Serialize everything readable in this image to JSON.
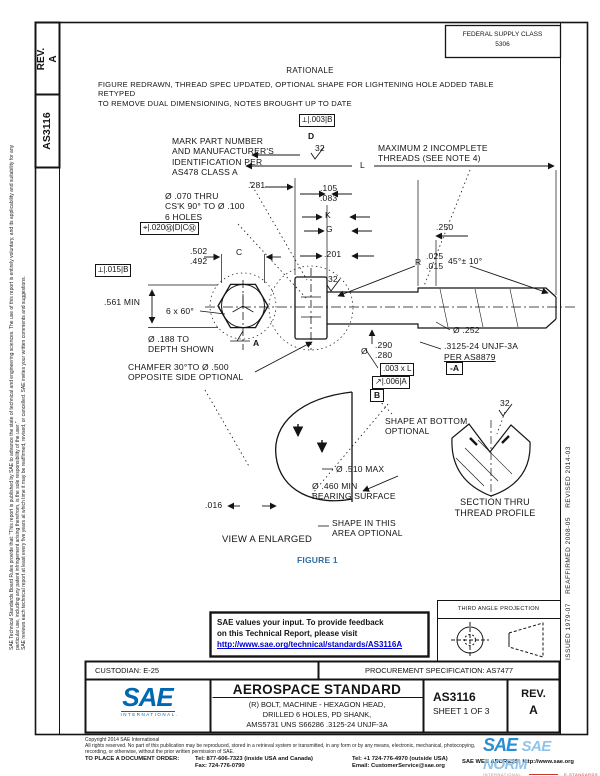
{
  "document": {
    "rev_label": "REV.",
    "rev_value": "A",
    "doc_number": "AS3116",
    "federal_supply_class": "FEDERAL SUPPLY CLASS",
    "federal_supply_value": "5306"
  },
  "rationale": {
    "title": "RATIONALE",
    "text": "FIGURE REDRAWN, THREAD SPEC UPDATED, OPTIONAL SHAPE FOR LIGHTENING HOLE ADDED TABLE RETYPED\nTO REMOVE DUAL DIMENSIONING, NOTES BROUGHT UP TO DATE"
  },
  "margins": {
    "left_legal_1": "SAE Technical Standards Board Rules provide that: \"This report is published by SAE to advance the state of technical and engineering sciences. The use of this report is entirely voluntary, and its applicability and suitability for any particular use, including any patent infringement arising therefrom, is the sole responsibility of the user.\"",
    "left_legal_2": "SAE reviews each technical report at least every five years at which time it may be reaffirmed, revised, or cancelled. SAE invites your written comments and suggestions.",
    "revision_history": "ISSUED 1979-07    REAFFIRMED 2008-05    REVISED 2014-03"
  },
  "drawing": {
    "figure_caption": "FIGURE 1",
    "callouts": {
      "fcf_top": "⟂|.003|B",
      "datum_d": "D",
      "finish_top": "32",
      "mark_part": "MARK PART NUMBER\nAND MANUFACTURER'S\nIDENTIFICATION PER\nAS478 CLASS A",
      "max_threads": "MAXIMUM 2 INCOMPLETE\nTHREADS (SEE NOTE 4)",
      "dim_l": "L",
      "dim_281": ".281",
      "dim_105_083": ".105\n.083",
      "dim_k": "K",
      "dim_g": "G",
      "hole_note": "Ø .070 THRU\nCS'K 90° TO Ø .100\n6 HOLES",
      "fcf_position": "⌖|.020Ⓜ|D|CⓂ",
      "dim_502_492": ".502\n.492",
      "dim_c": "C",
      "dim_201": ".201",
      "dim_r": "R",
      "dim_r_vals": ".025\n.015",
      "dim_250": ".250",
      "dim_45": "45°± 10°",
      "fcf_perp": "⟂|.015|B",
      "dim_561": ".561 MIN",
      "dim_6x60": "6 x 60°",
      "finish_head": "32",
      "dim_188": "Ø .188 TO\nDEPTH SHOWN",
      "view_arrow": "A",
      "chamfer_note": "CHAMFER 30°TO Ø .500\nOPPOSITE SIDE OPTIONAL",
      "dim_290_dia": "Ø",
      "dim_290_vals": ".290\n.280",
      "dim_252": "Ø .252",
      "thread_spec_1": ".3125-24 UNJF-3A",
      "thread_spec_2": "PER AS8879",
      "datum_a": "-A",
      "fcf_straight": ".003 x L",
      "fcf_runout": "↗|.006|A",
      "datum_b": "B",
      "shape_bottom": "SHAPE AT BOTTOM\nOPTIONAL",
      "finish_section": "32",
      "dim_510": "Ø .510 MAX",
      "dim_460": "Ø .460 MIN\nBEARING SURFACE",
      "dim_016": ".016",
      "shape_area": "SHAPE IN THIS\nAREA OPTIONAL",
      "view_a_title": "VIEW A ENLARGED",
      "section_title": "SECTION THRU\nTHREAD PROFILE"
    }
  },
  "feedback": {
    "line1": "SAE values your input. To provide feedback",
    "line2": "on this Technical Report, please visit",
    "link": "http://www.sae.org/technical/standards/AS3116A"
  },
  "projection": {
    "title": "THIRD ANGLE PROJECTION"
  },
  "title_block": {
    "custodian": "CUSTODIAN: E-25",
    "procurement": "PROCUREMENT SPECIFICATION: AS7477",
    "logo_text": "SAE",
    "logo_sub": "INTERNATIONAL.",
    "standard_type": "AEROSPACE STANDARD",
    "title": "(R) BOLT, MACHINE - HEXAGON HEAD,\nDRILLED 6 HOLES, PD SHANK,\nAMS5731  UNS S66286  .3125-24 UNJF-3A",
    "doc_number": "AS3116",
    "sheet": "SHEET 1 OF 3",
    "rev_label": "REV.",
    "rev_value": "A"
  },
  "footer": {
    "copyright": "Copyright 2014 SAE International",
    "rights": "All rights reserved. No part of this publication may be reproduced, stored in a retrieval system or transmitted, in any form or by any means, electronic, mechanical, photocopying,\nrecording, or otherwise, without the prior written permission of SAE.",
    "order_label": "TO PLACE A DOCUMENT ORDER:",
    "tel_inside": "Tel: 877-606-7323 (inside USA and Canada)",
    "fax": "Fax: 724-776-0790",
    "tel_outside": "Tel: +1 724-776-4970 (outside USA)",
    "email": "Email: CustomerService@sae.org",
    "web": "SAE WEB ADDRESS: http://www.sae.org"
  },
  "watermark": {
    "brand": "SAE",
    "text": "SAE NORM",
    "sub": "INTERNATIONAL.",
    "accent": "E-STANDARDS"
  },
  "colors": {
    "link": "#0000d0",
    "figure": "#2e6da4",
    "sae_blue": "#0068b3",
    "watermark_blue": "#8fc3ea",
    "watermark_red": "#cc3333"
  }
}
